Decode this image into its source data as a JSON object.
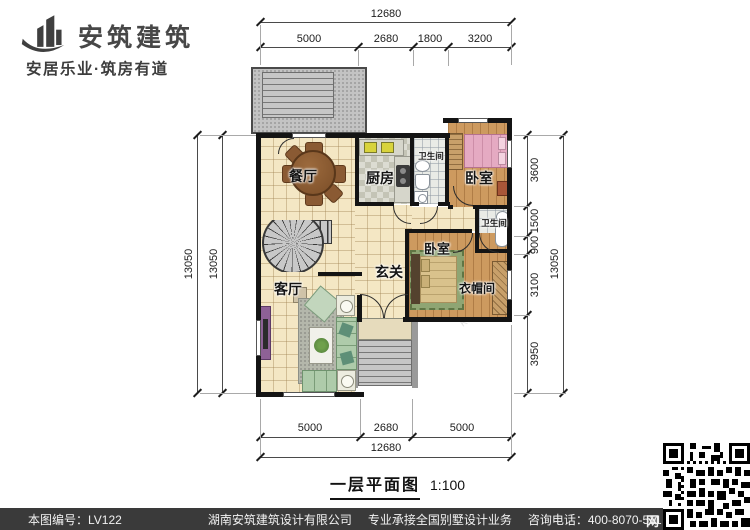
{
  "brand": {
    "name": "安筑建筑",
    "tagline": "安居乐业·筑房有道"
  },
  "title": {
    "name": "一层平面图",
    "scale": "1:100"
  },
  "rooms": {
    "dining": "餐厅",
    "kitchen": "厨房",
    "bath1": "卫生间",
    "bedroom1": "卧室",
    "bath2": "卫生间",
    "bedroom2": "卧室",
    "foyer": "玄关",
    "cloak": "衣帽间",
    "living": "客厅"
  },
  "dims": {
    "top": {
      "total": "12680",
      "segs": [
        "5000",
        "2680",
        "1800",
        "3200"
      ]
    },
    "bottom": {
      "total": "12680",
      "segs": [
        "5000",
        "2680",
        "5000"
      ]
    },
    "left": {
      "outer": "13050",
      "inner": "13050"
    },
    "right": {
      "total": "13050",
      "segs": [
        "3600",
        "1500",
        "900",
        "3100",
        "3950"
      ]
    }
  },
  "footer": {
    "sheet_no": "本图编号：LV122",
    "company": "湖南安筑建筑设计有限公司",
    "service": "专业承接全国别墅设计业务",
    "phone": "咨询电话：400-8070-511",
    "net": "网"
  },
  "watermarks": {
    "a": "ku8z.com",
    "b": "安筑建筑"
  },
  "colors": {
    "wall": "#141414",
    "floor_tile": "#f4e7c4",
    "wood": "#cd9a5f",
    "terrace": "#c3c3c3",
    "bed_pink": "#e5aac2",
    "rug_green": "#8fa573",
    "sofa_green": "#aecbaa",
    "cabinet_purple": "#8e6196",
    "footer_bar": "#3a3a3a"
  }
}
